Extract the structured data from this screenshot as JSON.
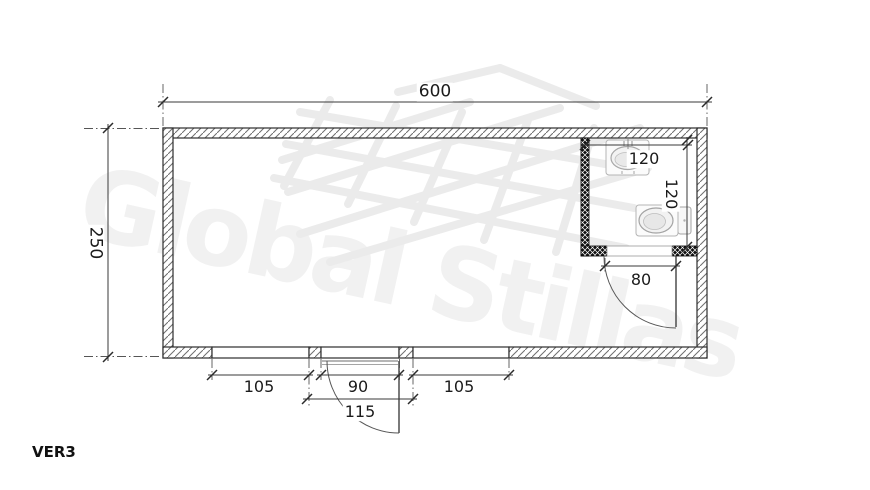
{
  "version_label": "VER3",
  "watermark": {
    "text": "Global Stillas",
    "scaffold_icon": "scaffold-grid-icon"
  },
  "dimensions": {
    "overall_width": "600",
    "overall_depth": "250",
    "bathroom_width": "120",
    "bathroom_depth": "120",
    "bathroom_door_width": "80",
    "left_window_width": "105",
    "entrance_door_width": "90",
    "right_window_width": "105",
    "entrance_opening_width": "115"
  },
  "fixtures": {
    "sink": "sink-top-view",
    "toilet": "toilet-top-view"
  },
  "colors": {
    "drawing_line": "#333333",
    "dark_wall": "#111111",
    "watermark": "#f1f1f1",
    "label_text": "#1b1b1b",
    "background": "#ffffff"
  }
}
